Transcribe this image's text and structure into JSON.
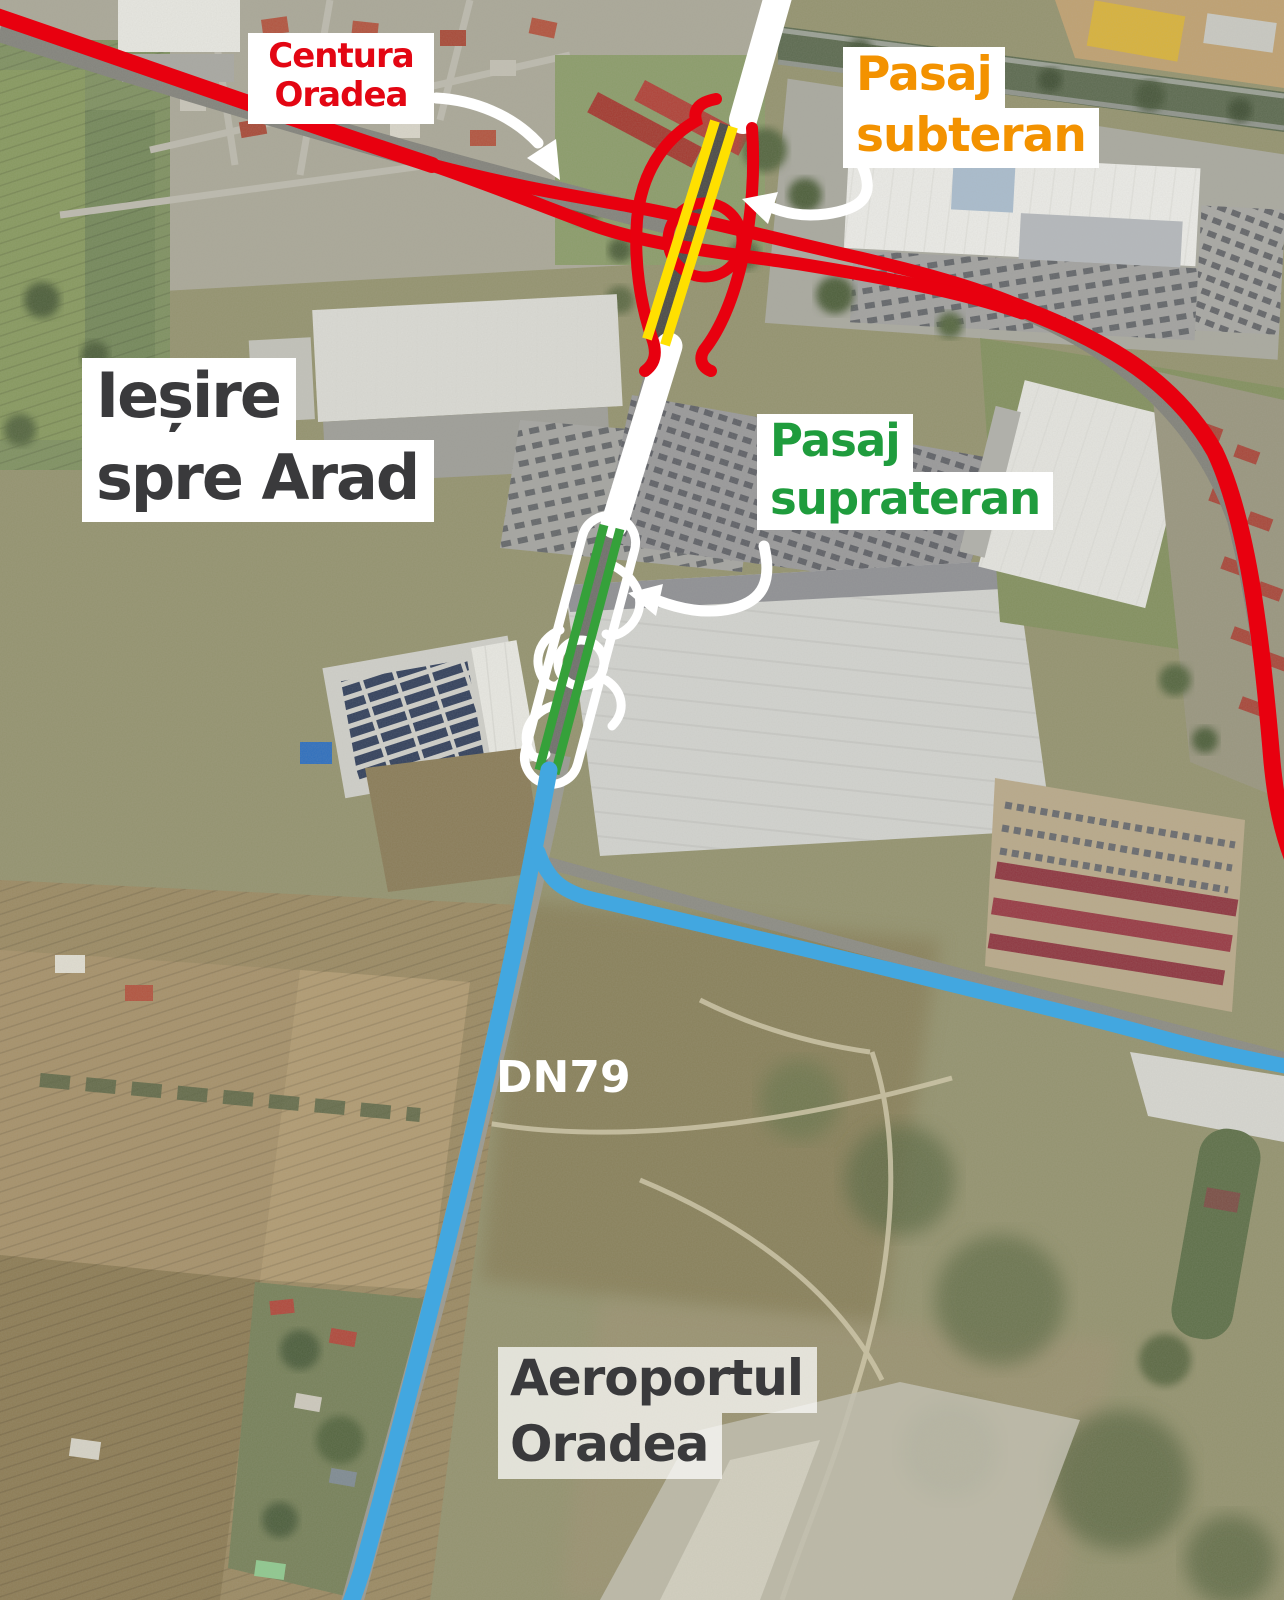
{
  "annotations": {
    "centura_oradea": {
      "line1": "Centura",
      "line2": "Oradea",
      "color": "#e30613"
    },
    "pasaj_subteran": {
      "line1": "Pasaj",
      "line2": "subteran",
      "color": "#f39200"
    },
    "iesire_spre_arad": {
      "line1": "Ieșire",
      "line2": "spre Arad",
      "color": "#3a3a3c"
    },
    "pasaj_suprateran": {
      "line1": "Pasaj",
      "line2": "suprateran",
      "color": "#1f9c3d"
    },
    "dn79": {
      "label": "DN79",
      "color": "#ffffff"
    },
    "aeroportul_oradea": {
      "line1": "Aeroportul",
      "line2": "Oradea",
      "color": "#3a3a3c"
    }
  },
  "road_colors": {
    "ring_road": "#e8000f",
    "underpass_highlight": "#ffe000",
    "overpass_highlight": "#35a13a",
    "dn79_road": "#42a7e0",
    "connector_road": "#ffffff",
    "arrow": "#ffffff"
  },
  "label_backgrounds": {
    "solid": "#ffffff",
    "translucent": "rgba(255,255,255,0.72)"
  }
}
